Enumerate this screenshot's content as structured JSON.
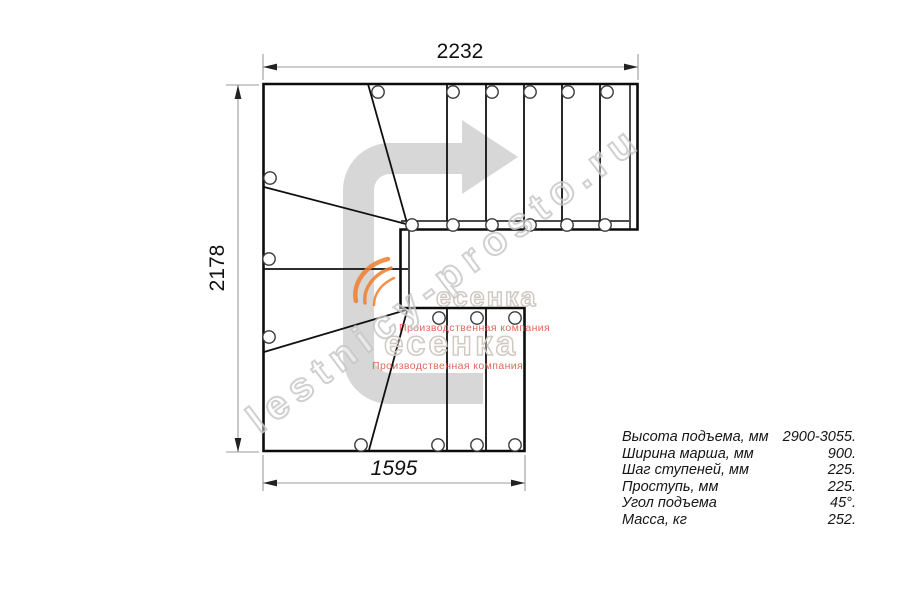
{
  "diagram": {
    "title": "stair-plan-top-view",
    "dimensions": {
      "top_width_mm": "2232",
      "left_height_mm": "2178",
      "bottom_width_mm": "1595"
    },
    "specs": {
      "rows": [
        {
          "label": "Высота подъема, мм",
          "value": "2900-3055."
        },
        {
          "label": "Ширина марша, мм",
          "value": "900."
        },
        {
          "label": "Шаг ступеней, мм",
          "value": "225."
        },
        {
          "label": "Проступь, мм",
          "value": "225."
        },
        {
          "label": "Угол подъема",
          "value": "45°."
        },
        {
          "label": "Масса, кг",
          "value": "252."
        }
      ]
    },
    "watermark": {
      "site": "lestnicy-prosto.ru",
      "logo_word_small": "есенка",
      "logo_word_large": "есенка",
      "caption_small": "Производственная компания",
      "caption_large": "Производственная компания"
    },
    "colors": {
      "outline": "#0c0c0c",
      "step_line": "#101010",
      "dim_line": "#9b9b9b",
      "dim_arrow": "#222222",
      "arrow_fill": "#d7d7d7",
      "watermark_stroke": "#c8c8c8",
      "logo_gray": "#d0c9c2",
      "logo_red": "#e2574b",
      "logo_orange": "#ef7e2e"
    }
  }
}
